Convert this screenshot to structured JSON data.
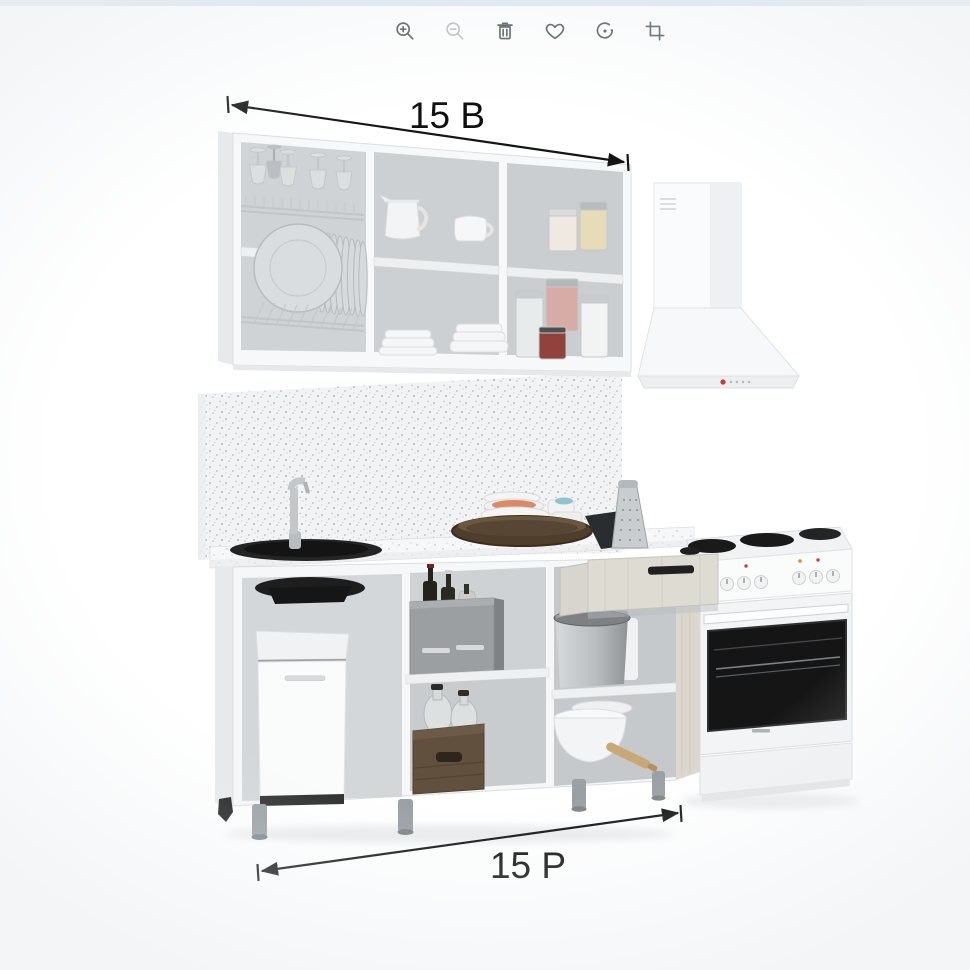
{
  "page": {
    "top_strip_color": "#dbe7f0",
    "background_color": "#ffffff"
  },
  "toolbar": {
    "icon_color": "#4c5256",
    "disabled_icon_color": "#b9bec1",
    "items": [
      {
        "name": "zoom-in",
        "enabled": true
      },
      {
        "name": "zoom-out",
        "enabled": false
      },
      {
        "name": "delete",
        "enabled": true
      },
      {
        "name": "favorite",
        "enabled": true
      },
      {
        "name": "rotate",
        "enabled": true
      },
      {
        "name": "crop",
        "enabled": true
      }
    ]
  },
  "product_image": {
    "subject": "kitchen-set-3d-render",
    "annotations": {
      "width_label": "15 B",
      "depth_label": "15 P",
      "annotation_color": "#111111"
    }
  }
}
